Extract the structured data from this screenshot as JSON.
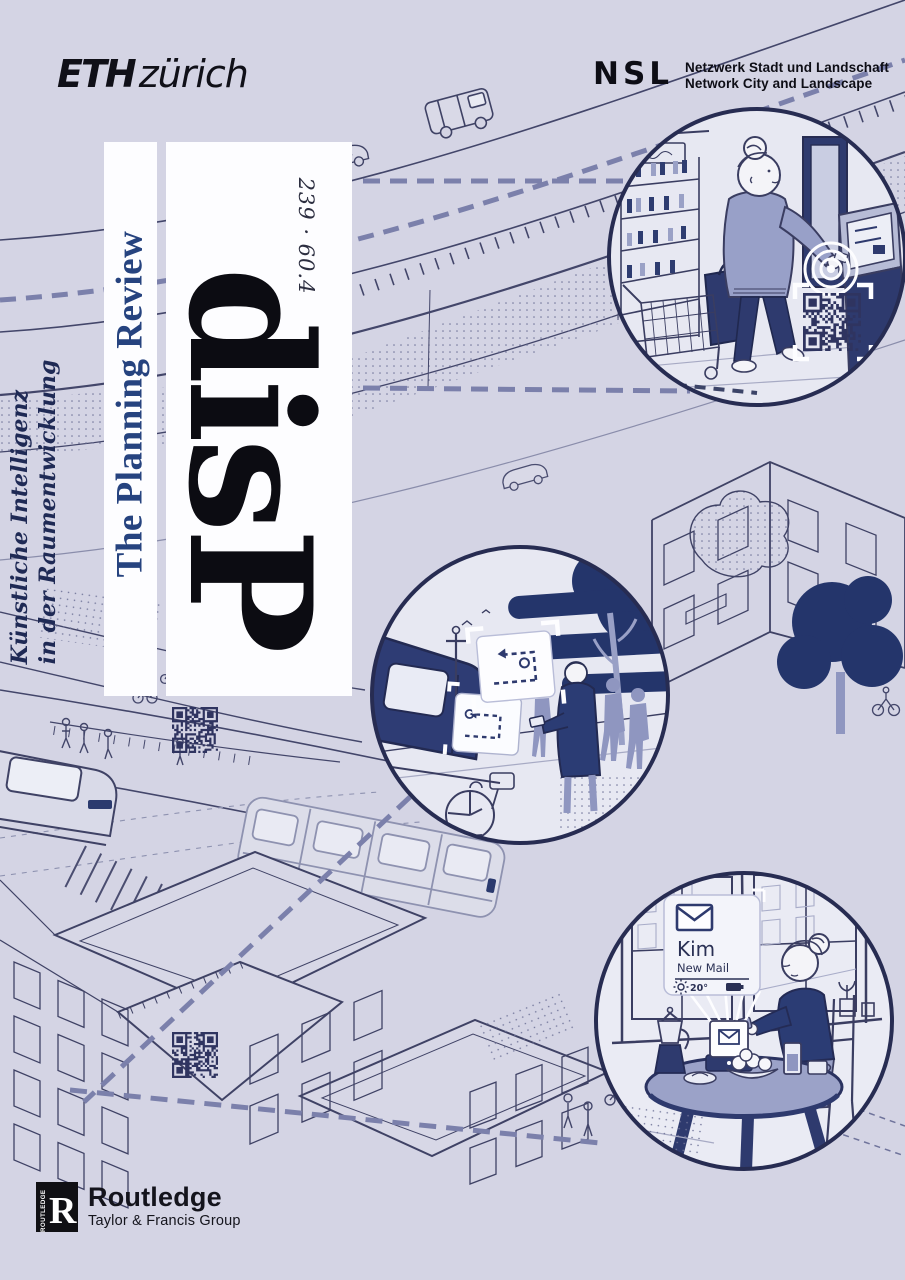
{
  "cover": {
    "header": {
      "eth_logo": {
        "eth": "ETH",
        "city": "zürich"
      },
      "nsl_logo": {
        "abbr": "NSL",
        "line1": "Netzwerk Stadt und Landschaft",
        "line2": "Network City and Landscape"
      }
    },
    "masthead": {
      "journal_logo": "disP",
      "journal_subtitle": "The Planning Review",
      "issue": "239 · 60.4",
      "theme_line1": "Künstliche Intelligenz",
      "theme_line2": "in der Raumentwicklung"
    },
    "publisher": {
      "imprint_vertical": "ROUTLEDGE",
      "imprint_initial": "R",
      "name": "Routledge",
      "group": "Taylor & Francis Group"
    },
    "notification_card": {
      "sender": "Kim",
      "subject": "New Mail",
      "temperature": "20°"
    },
    "colors": {
      "background": "#d4d4e4",
      "ink": "#3b3e60",
      "navy": "#2b3a6e",
      "slate": "#8f96c0",
      "review_blue": "#26437f",
      "ring": "#272c52",
      "panel": "#fdfdff"
    }
  }
}
